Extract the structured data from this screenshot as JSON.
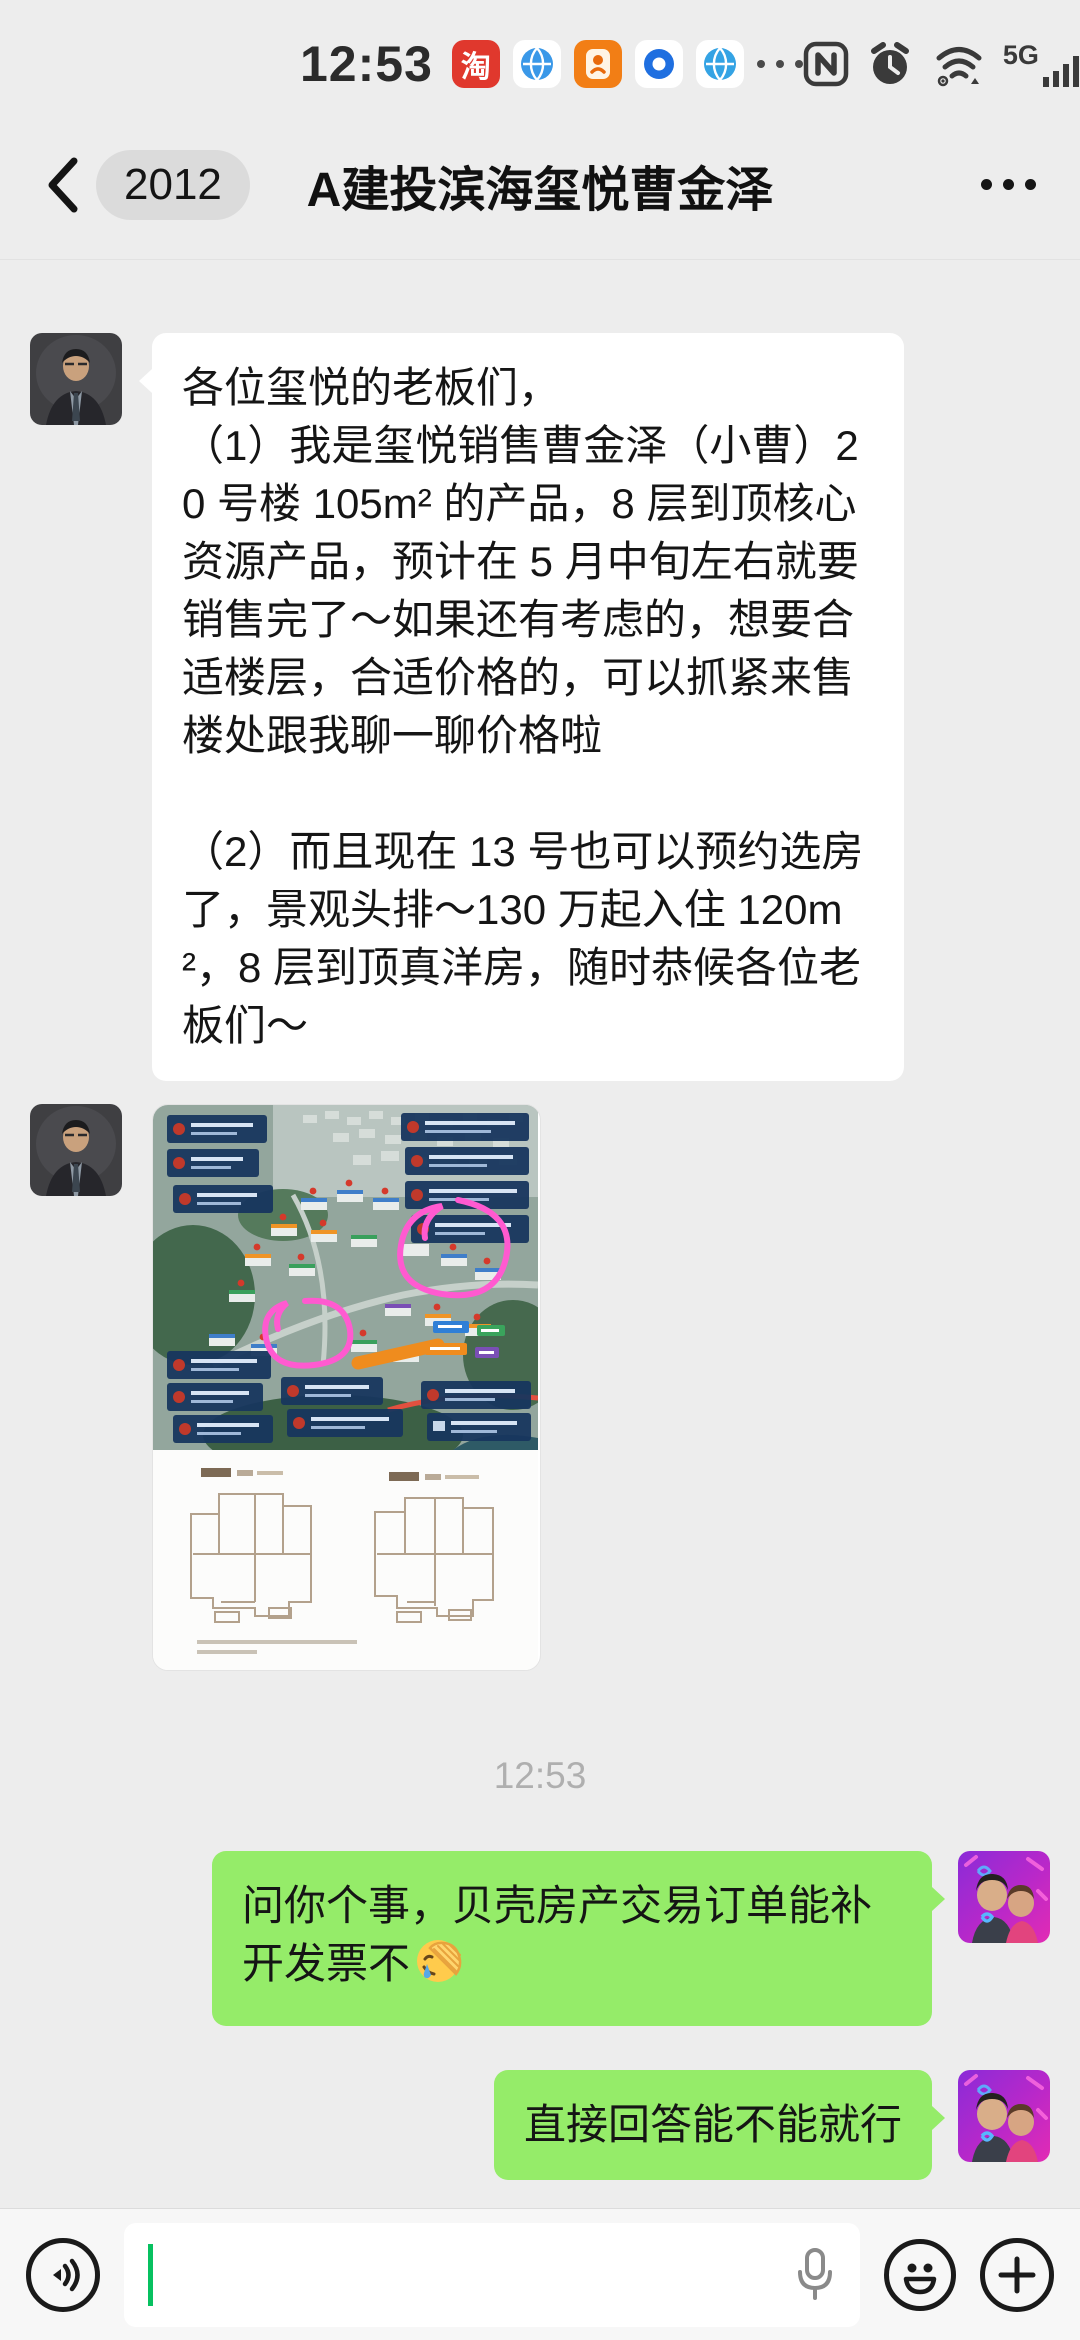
{
  "status_bar": {
    "time": "12:53",
    "taobao_char": "淘",
    "network_label": "5G",
    "battery_percent": "91",
    "notification_icons": [
      "taobao-icon",
      "globe-icon",
      "orange-app-icon",
      "blue-ring-icon",
      "globe-icon",
      "more-dots-icon"
    ],
    "system_icons": [
      "nfc-icon",
      "alarm-icon",
      "wifi-hotspot-icon",
      "signal-bars-icon",
      "battery-icon",
      "charging-bolt-icon"
    ]
  },
  "nav_bar": {
    "unread_badge": "2012",
    "title": "A建投滨海玺悦曹金泽",
    "icons": [
      "back-chevron-icon",
      "more-menu-icon"
    ]
  },
  "chat": {
    "timestamp": "12:53",
    "bubble_colors": {
      "incoming": "#FFFFFF",
      "outgoing": "#95EC69"
    },
    "timestamp_color": "#AFAFAF",
    "messages": [
      {
        "direction": "incoming",
        "type": "text",
        "text": "各位玺悦的老板们，\n（1）我是玺悦销售曹金泽（小曹）20 号楼 105m² 的产品，8 层到顶核心资源产品，预计在 5 月中旬左右就要销售完了～如果还有考虑的，想要合适楼层，合适价格的，可以抓紧来售楼处跟我聊一聊价格啦\n\n（2）而且现在 13 号也可以预约选房了，景观头排～130 万起入住 120m²，8 层到顶真洋房，随时恭候各位老板们～"
      },
      {
        "direction": "incoming",
        "type": "image",
        "alt": "楼盘鸟瞰图与户型图"
      },
      {
        "direction": "outgoing",
        "type": "text",
        "text": "问你个事，贝壳房产交易订单能补开发票不",
        "emoji": "facepalm"
      },
      {
        "direction": "outgoing",
        "type": "text",
        "text": "直接回答能不能就行"
      }
    ]
  },
  "input_bar": {
    "value": "",
    "placeholder": "",
    "cursor_color": "#07C160",
    "icons": [
      "voice-toggle-icon",
      "mic-icon",
      "emoji-icon",
      "plus-icon"
    ]
  }
}
